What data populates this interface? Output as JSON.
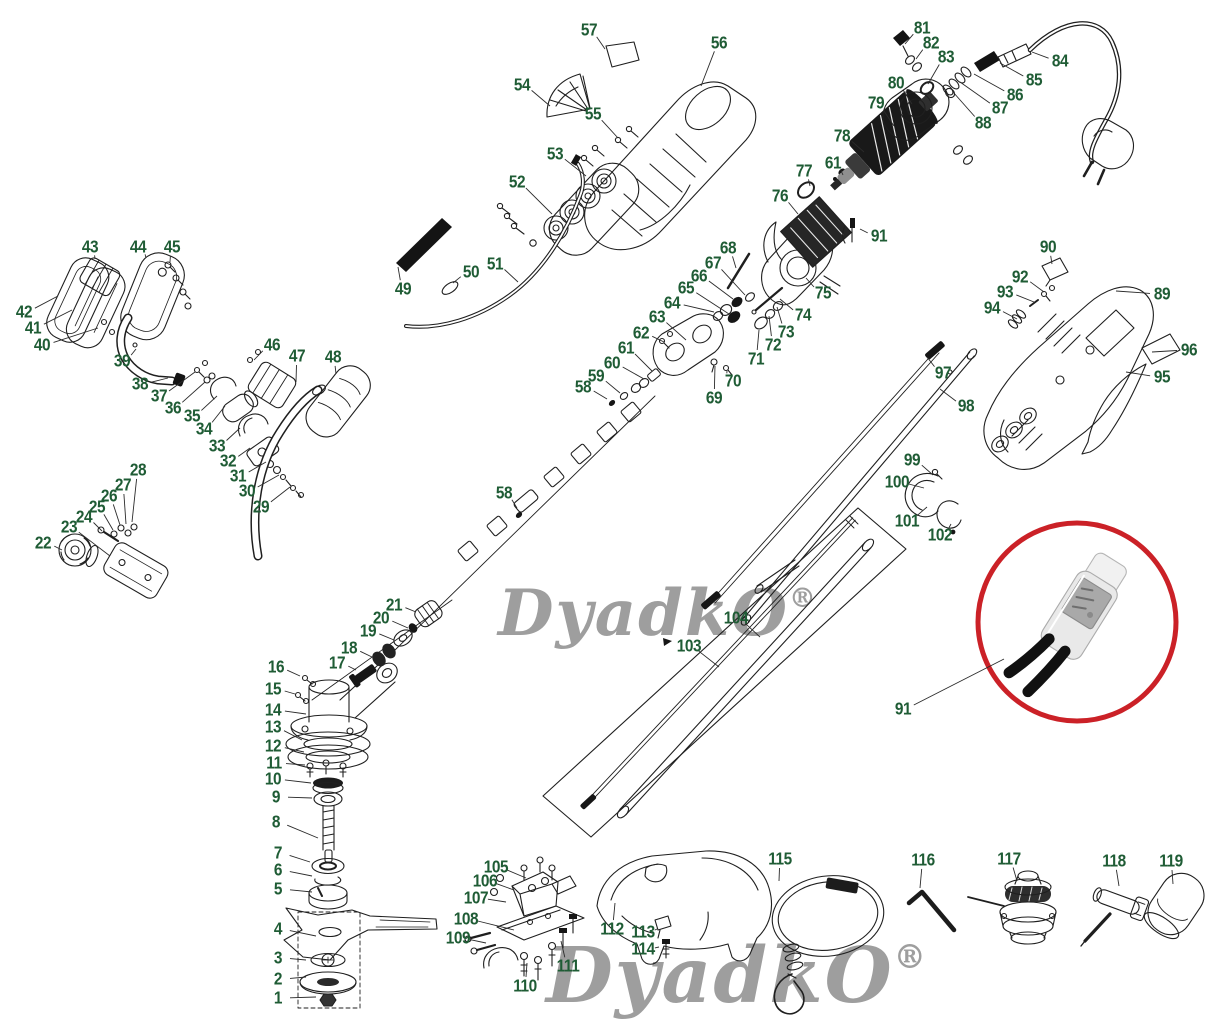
{
  "diagram": {
    "type": "exploded-parts-diagram",
    "subject": "electric grass trimmer brush cutter parts",
    "label_color": "#1f5c35",
    "line_color": "#1f1f1f",
    "leader_color": "#2b2b2b",
    "watermark": {
      "text": "DyadkO",
      "registered_mark": "®",
      "color": "#9e9e9e"
    },
    "inset": {
      "shape": "red-circle",
      "color": "#cb2127",
      "part_number": "91",
      "content": "thermal-protector-photo"
    },
    "callouts": [
      {
        "n": "1",
        "x": 278,
        "y": 998,
        "lx": 316,
        "ly": 997
      },
      {
        "n": "2",
        "x": 278,
        "y": 979,
        "lx": 306,
        "ly": 977
      },
      {
        "n": "3",
        "x": 278,
        "y": 958,
        "lx": 306,
        "ly": 960
      },
      {
        "n": "4",
        "x": 278,
        "y": 929,
        "lx": 316,
        "ly": 936
      },
      {
        "n": "5",
        "x": 278,
        "y": 889,
        "lx": 312,
        "ly": 892
      },
      {
        "n": "6",
        "x": 278,
        "y": 870,
        "lx": 312,
        "ly": 876
      },
      {
        "n": "7",
        "x": 278,
        "y": 853,
        "lx": 310,
        "ly": 862
      },
      {
        "n": "8",
        "x": 276,
        "y": 822,
        "lx": 318,
        "ly": 838
      },
      {
        "n": "9",
        "x": 276,
        "y": 797,
        "lx": 312,
        "ly": 798
      },
      {
        "n": "10",
        "x": 273,
        "y": 779,
        "lx": 311,
        "ly": 783
      },
      {
        "n": "11",
        "x": 274,
        "y": 763,
        "lx": 305,
        "ly": 765
      },
      {
        "n": "12",
        "x": 273,
        "y": 746,
        "lx": 304,
        "ly": 752
      },
      {
        "n": "13",
        "x": 273,
        "y": 727,
        "lx": 302,
        "ly": 740
      },
      {
        "n": "14",
        "x": 273,
        "y": 710,
        "lx": 306,
        "ly": 714
      },
      {
        "n": "15",
        "x": 273,
        "y": 689,
        "lx": 295,
        "ly": 694
      },
      {
        "n": "16",
        "x": 276,
        "y": 667,
        "lx": 300,
        "ly": 676
      },
      {
        "n": "17",
        "x": 337,
        "y": 663,
        "lx": 356,
        "ly": 670
      },
      {
        "n": "18",
        "x": 349,
        "y": 648,
        "lx": 372,
        "ly": 657
      },
      {
        "n": "19",
        "x": 368,
        "y": 631,
        "lx": 394,
        "ly": 640
      },
      {
        "n": "20",
        "x": 381,
        "y": 618,
        "lx": 408,
        "ly": 628
      },
      {
        "n": "21",
        "x": 394,
        "y": 605,
        "lx": 416,
        "ly": 612
      },
      {
        "n": "22",
        "x": 43,
        "y": 543,
        "lx": 62,
        "ly": 550
      },
      {
        "n": "23",
        "x": 69,
        "y": 527,
        "lx": 110,
        "ly": 556
      },
      {
        "n": "24",
        "x": 84,
        "y": 517,
        "lx": 102,
        "ly": 531
      },
      {
        "n": "25",
        "x": 97,
        "y": 507,
        "lx": 113,
        "ly": 530
      },
      {
        "n": "26",
        "x": 109,
        "y": 496,
        "lx": 120,
        "ly": 525
      },
      {
        "n": "27",
        "x": 123,
        "y": 485,
        "lx": 126,
        "ly": 524
      },
      {
        "n": "28",
        "x": 138,
        "y": 470,
        "lx": 132,
        "ly": 522
      },
      {
        "n": "29",
        "x": 261,
        "y": 507,
        "lx": 290,
        "ly": 487
      },
      {
        "n": "30",
        "x": 247,
        "y": 491,
        "lx": 279,
        "ly": 475
      },
      {
        "n": "31",
        "x": 238,
        "y": 476,
        "lx": 266,
        "ly": 462
      },
      {
        "n": "32",
        "x": 228,
        "y": 461,
        "lx": 250,
        "ly": 448
      },
      {
        "n": "33",
        "x": 217,
        "y": 446,
        "lx": 240,
        "ly": 428
      },
      {
        "n": "34",
        "x": 204,
        "y": 429,
        "lx": 225,
        "ly": 406
      },
      {
        "n": "35",
        "x": 192,
        "y": 416,
        "lx": 217,
        "ly": 396
      },
      {
        "n": "36",
        "x": 173,
        "y": 408,
        "lx": 205,
        "ly": 382
      },
      {
        "n": "37",
        "x": 159,
        "y": 396,
        "lx": 195,
        "ly": 372
      },
      {
        "n": "38",
        "x": 140,
        "y": 384,
        "lx": 168,
        "ly": 378
      },
      {
        "n": "39",
        "x": 122,
        "y": 361,
        "lx": 136,
        "ly": 349
      },
      {
        "n": "40",
        "x": 42,
        "y": 345,
        "lx": 98,
        "ly": 328
      },
      {
        "n": "41",
        "x": 33,
        "y": 328,
        "lx": 72,
        "ly": 310
      },
      {
        "n": "42",
        "x": 24,
        "y": 312,
        "lx": 58,
        "ly": 296
      },
      {
        "n": "43",
        "x": 90,
        "y": 247,
        "lx": 95,
        "ly": 259
      },
      {
        "n": "44",
        "x": 138,
        "y": 247,
        "lx": 146,
        "ly": 258
      },
      {
        "n": "45",
        "x": 172,
        "y": 247,
        "lx": 170,
        "ly": 262
      },
      {
        "n": "46",
        "x": 272,
        "y": 345,
        "lx": 254,
        "ly": 360
      },
      {
        "n": "47",
        "x": 297,
        "y": 356,
        "lx": 296,
        "ly": 382
      },
      {
        "n": "48",
        "x": 333,
        "y": 357,
        "lx": 336,
        "ly": 374
      },
      {
        "n": "49",
        "x": 403,
        "y": 289,
        "lx": 398,
        "ly": 267
      },
      {
        "n": "50",
        "x": 471,
        "y": 272,
        "lx": 453,
        "ly": 283
      },
      {
        "n": "51",
        "x": 495,
        "y": 264,
        "lx": 518,
        "ly": 282
      },
      {
        "n": "52",
        "x": 517,
        "y": 182,
        "lx": 552,
        "ly": 214
      },
      {
        "n": "53",
        "x": 555,
        "y": 154,
        "lx": 586,
        "ly": 176
      },
      {
        "n": "54",
        "x": 522,
        "y": 85,
        "lx": 550,
        "ly": 106
      },
      {
        "n": "55",
        "x": 593,
        "y": 114,
        "lx": 618,
        "ly": 138
      },
      {
        "n": "56",
        "x": 719,
        "y": 43,
        "lx": 701,
        "ly": 86
      },
      {
        "n": "57",
        "x": 589,
        "y": 30,
        "lx": 605,
        "ly": 49
      },
      {
        "n": "58",
        "x": 583,
        "y": 387,
        "lx": 607,
        "ly": 399
      },
      {
        "n": "58",
        "x": 504,
        "y": 493,
        "lx": 517,
        "ly": 508
      },
      {
        "n": "59",
        "x": 596,
        "y": 376,
        "lx": 620,
        "ly": 393
      },
      {
        "n": "60",
        "x": 612,
        "y": 363,
        "lx": 644,
        "ly": 379
      },
      {
        "n": "61",
        "x": 626,
        "y": 348,
        "lx": 652,
        "ly": 371
      },
      {
        "n": "61",
        "x": 833,
        "y": 163,
        "lx": 843,
        "ly": 175
      },
      {
        "n": "62",
        "x": 641,
        "y": 333,
        "lx": 664,
        "ly": 342
      },
      {
        "n": "63",
        "x": 657,
        "y": 317,
        "lx": 686,
        "ly": 340
      },
      {
        "n": "64",
        "x": 672,
        "y": 303,
        "lx": 714,
        "ly": 312
      },
      {
        "n": "65",
        "x": 686,
        "y": 288,
        "lx": 729,
        "ly": 314
      },
      {
        "n": "66",
        "x": 699,
        "y": 276,
        "lx": 733,
        "ly": 299
      },
      {
        "n": "67",
        "x": 713,
        "y": 263,
        "lx": 745,
        "ly": 295
      },
      {
        "n": "68",
        "x": 728,
        "y": 248,
        "lx": 736,
        "ly": 268
      },
      {
        "n": "69",
        "x": 714,
        "y": 398,
        "lx": 715,
        "ly": 366
      },
      {
        "n": "70",
        "x": 733,
        "y": 381,
        "lx": 727,
        "ly": 371
      },
      {
        "n": "71",
        "x": 756,
        "y": 359,
        "lx": 759,
        "ly": 330
      },
      {
        "n": "72",
        "x": 773,
        "y": 345,
        "lx": 769,
        "ly": 316
      },
      {
        "n": "73",
        "x": 786,
        "y": 332,
        "lx": 777,
        "ly": 307
      },
      {
        "n": "74",
        "x": 803,
        "y": 315,
        "lx": 780,
        "ly": 299
      },
      {
        "n": "75",
        "x": 823,
        "y": 293,
        "lx": 806,
        "ly": 278
      },
      {
        "n": "76",
        "x": 780,
        "y": 196,
        "lx": 798,
        "ly": 214
      },
      {
        "n": "77",
        "x": 804,
        "y": 171,
        "lx": 810,
        "ly": 186
      },
      {
        "n": "78",
        "x": 842,
        "y": 136,
        "lx": 864,
        "ly": 152
      },
      {
        "n": "79",
        "x": 876,
        "y": 103,
        "lx": 894,
        "ly": 126
      },
      {
        "n": "80",
        "x": 896,
        "y": 83,
        "lx": 912,
        "ly": 104
      },
      {
        "n": "81",
        "x": 922,
        "y": 28,
        "lx": 905,
        "ly": 44
      },
      {
        "n": "82",
        "x": 931,
        "y": 43,
        "lx": 916,
        "ly": 59
      },
      {
        "n": "83",
        "x": 946,
        "y": 57,
        "lx": 928,
        "ly": 84
      },
      {
        "n": "84",
        "x": 1060,
        "y": 61,
        "lx": 1032,
        "ly": 52
      },
      {
        "n": "85",
        "x": 1034,
        "y": 80,
        "lx": 1000,
        "ly": 63
      },
      {
        "n": "86",
        "x": 1015,
        "y": 95,
        "lx": 974,
        "ly": 74
      },
      {
        "n": "87",
        "x": 1000,
        "y": 108,
        "lx": 960,
        "ly": 82
      },
      {
        "n": "88",
        "x": 983,
        "y": 123,
        "lx": 953,
        "ly": 92
      },
      {
        "n": "89",
        "x": 1162,
        "y": 294,
        "lx": 1116,
        "ly": 291
      },
      {
        "n": "90",
        "x": 1048,
        "y": 247,
        "lx": 1052,
        "ly": 264
      },
      {
        "n": "91",
        "x": 879,
        "y": 236,
        "lx": 860,
        "ly": 229
      },
      {
        "n": "91",
        "x": 903,
        "y": 709,
        "lx": 1004,
        "ly": 659
      },
      {
        "n": "92",
        "x": 1020,
        "y": 277,
        "lx": 1044,
        "ly": 292
      },
      {
        "n": "93",
        "x": 1005,
        "y": 292,
        "lx": 1034,
        "ly": 302
      },
      {
        "n": "94",
        "x": 992,
        "y": 308,
        "lx": 1017,
        "ly": 319
      },
      {
        "n": "95",
        "x": 1162,
        "y": 377,
        "lx": 1126,
        "ly": 372
      },
      {
        "n": "96",
        "x": 1189,
        "y": 350,
        "lx": 1152,
        "ly": 352
      },
      {
        "n": "97",
        "x": 943,
        "y": 373,
        "lx": 927,
        "ly": 357
      },
      {
        "n": "98",
        "x": 966,
        "y": 406,
        "lx": 940,
        "ly": 389
      },
      {
        "n": "99",
        "x": 912,
        "y": 460,
        "lx": 933,
        "ly": 475
      },
      {
        "n": "100",
        "x": 897,
        "y": 482,
        "lx": 924,
        "ly": 488
      },
      {
        "n": "101",
        "x": 907,
        "y": 521,
        "lx": 927,
        "ly": 507
      },
      {
        "n": "102",
        "x": 940,
        "y": 535,
        "lx": 951,
        "ly": 524
      },
      {
        "n": "103",
        "x": 689,
        "y": 646,
        "lx": 719,
        "ly": 667
      },
      {
        "n": "104",
        "x": 736,
        "y": 618,
        "lx": 760,
        "ly": 637
      },
      {
        "n": "105",
        "x": 496,
        "y": 867,
        "lx": 526,
        "ly": 878
      },
      {
        "n": "106",
        "x": 485,
        "y": 881,
        "lx": 514,
        "ly": 890
      },
      {
        "n": "107",
        "x": 476,
        "y": 898,
        "lx": 506,
        "ly": 902
      },
      {
        "n": "108",
        "x": 466,
        "y": 919,
        "lx": 514,
        "ly": 930
      },
      {
        "n": "109",
        "x": 458,
        "y": 938,
        "lx": 486,
        "ly": 943
      },
      {
        "n": "110",
        "x": 525,
        "y": 986,
        "lx": 527,
        "ly": 963
      },
      {
        "n": "111",
        "x": 568,
        "y": 966,
        "lx": 561,
        "ly": 941
      },
      {
        "n": "112",
        "x": 612,
        "y": 929,
        "lx": 615,
        "ly": 903
      },
      {
        "n": "113",
        "x": 643,
        "y": 932,
        "lx": 657,
        "ly": 929
      },
      {
        "n": "114",
        "x": 643,
        "y": 949,
        "lx": 659,
        "ly": 947
      },
      {
        "n": "115",
        "x": 780,
        "y": 859,
        "lx": 779,
        "ly": 881
      },
      {
        "n": "116",
        "x": 923,
        "y": 860,
        "lx": 920,
        "ly": 888
      },
      {
        "n": "117",
        "x": 1009,
        "y": 859,
        "lx": 1017,
        "ly": 881
      },
      {
        "n": "118",
        "x": 1114,
        "y": 861,
        "lx": 1119,
        "ly": 886
      },
      {
        "n": "119",
        "x": 1171,
        "y": 861,
        "lx": 1173,
        "ly": 884
      }
    ]
  }
}
